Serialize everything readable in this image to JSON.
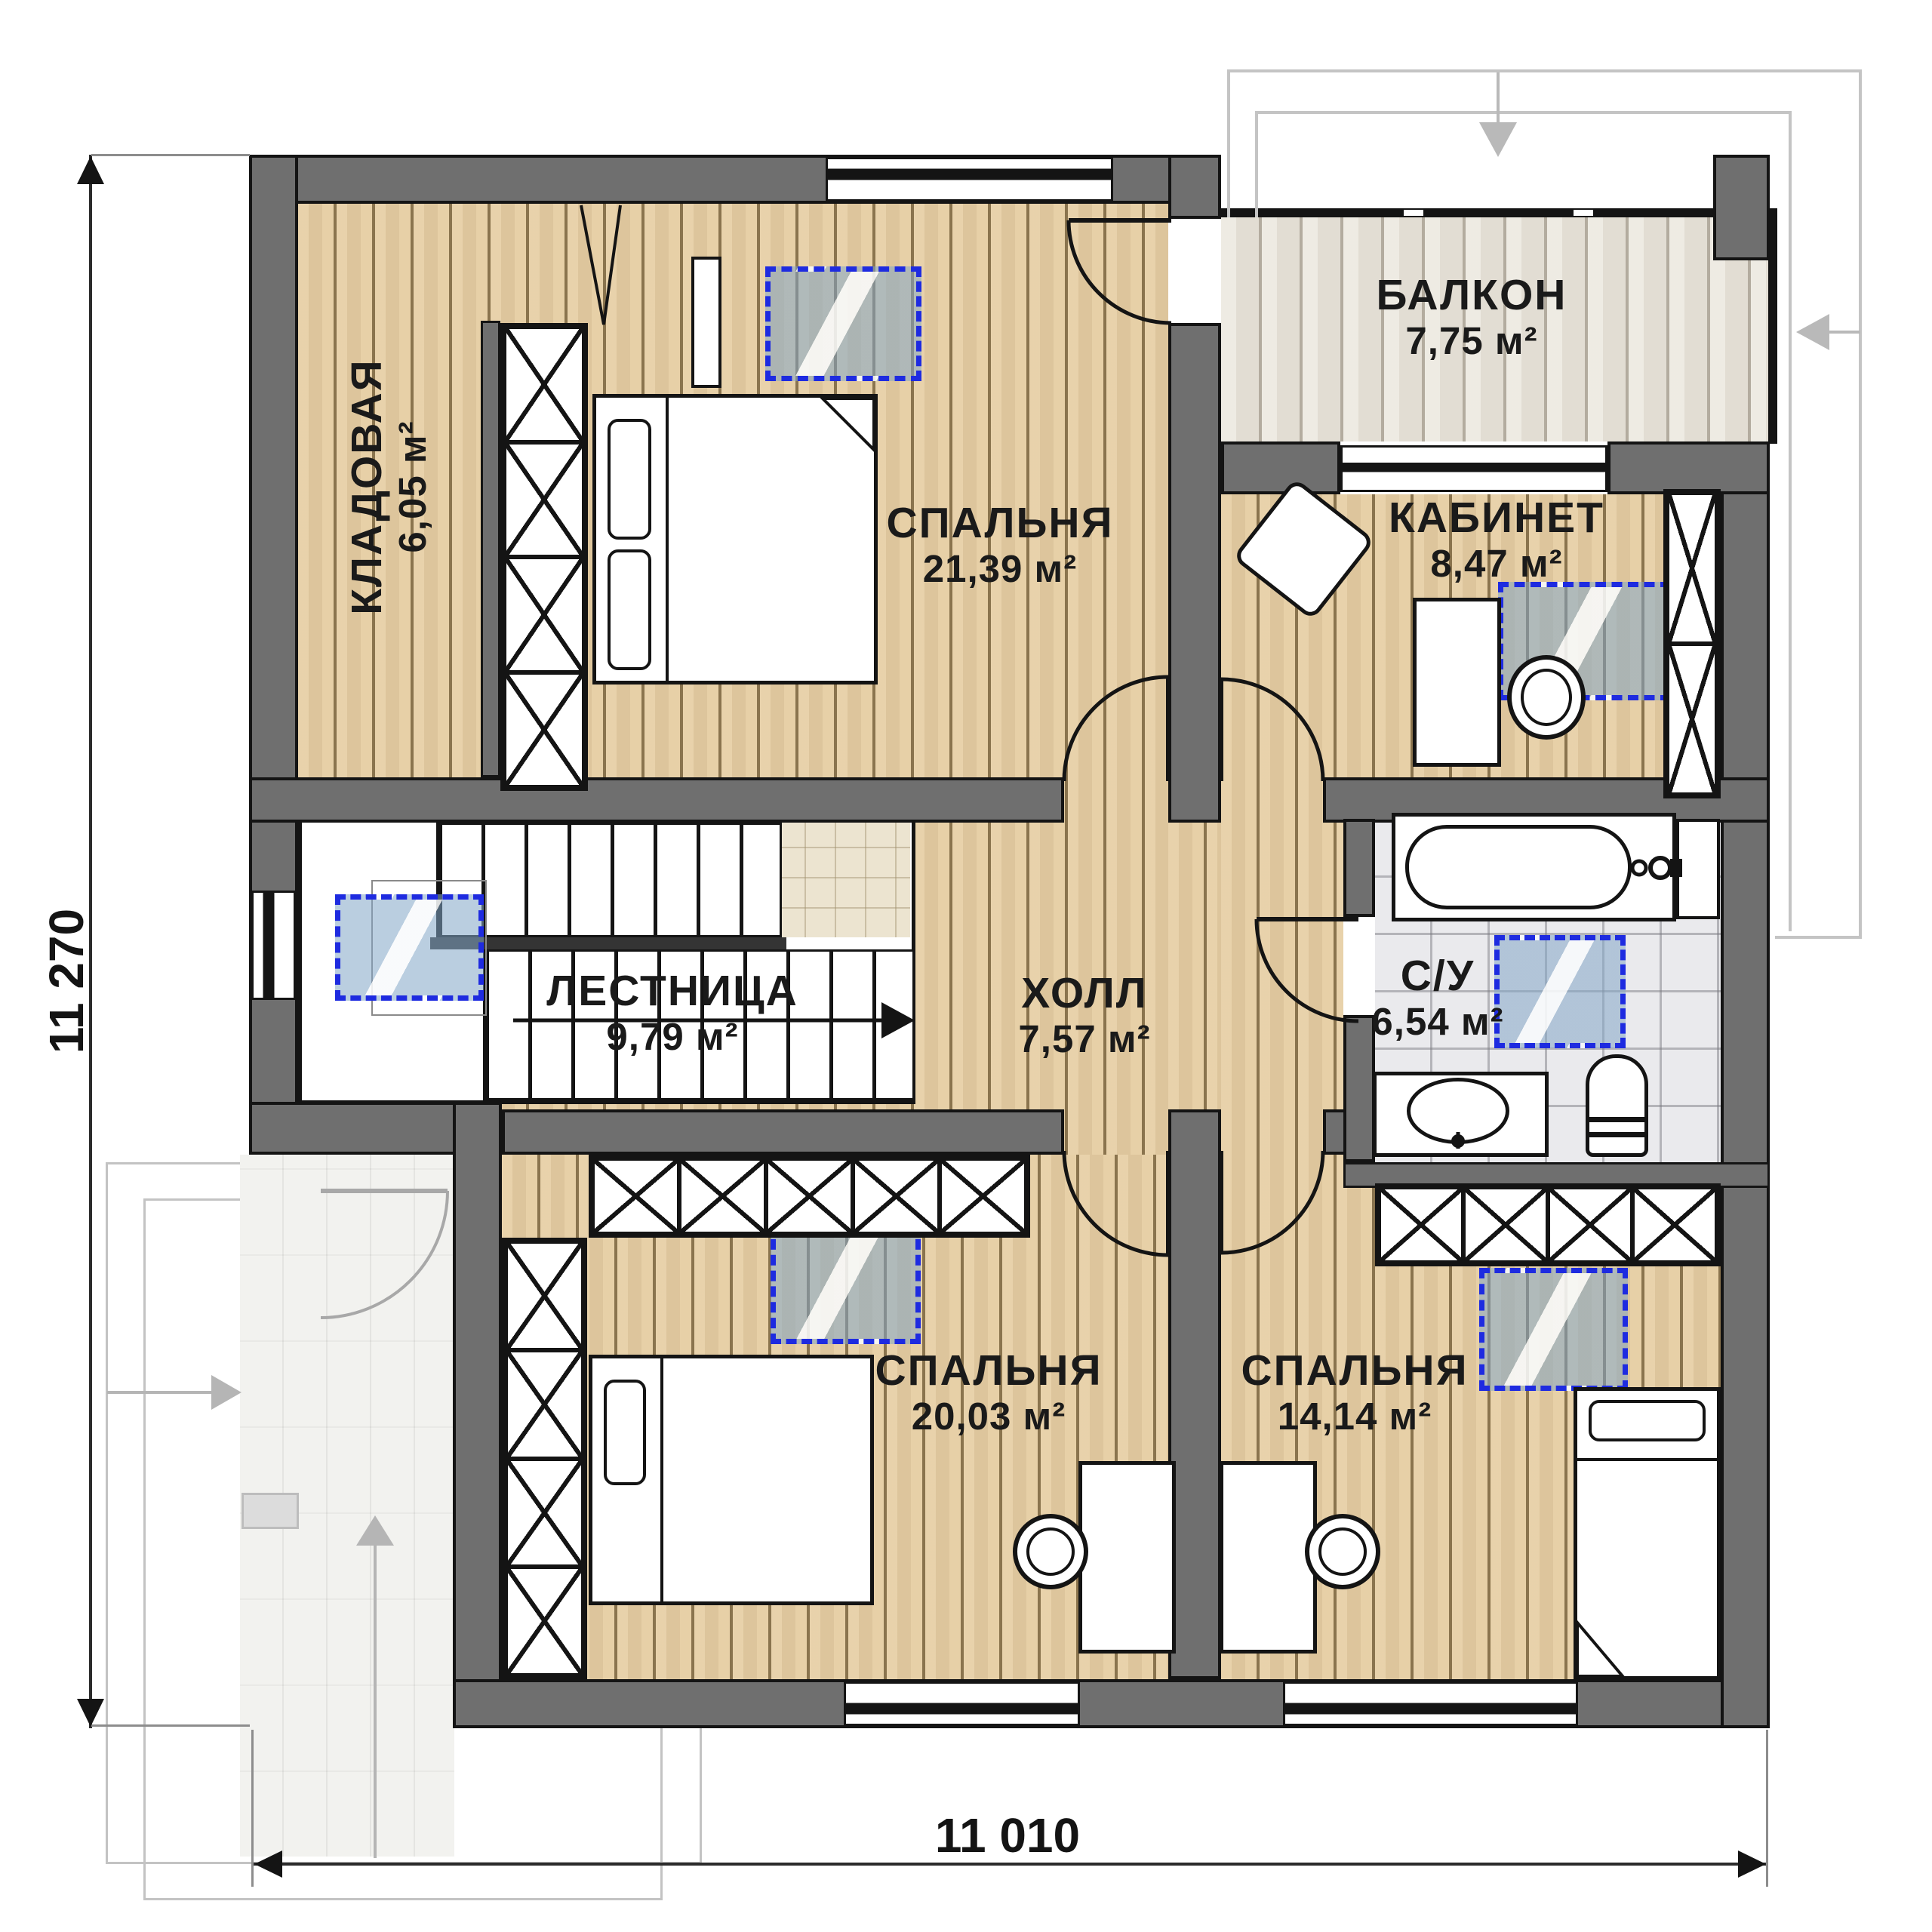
{
  "plan_title": "second-floor-plan",
  "rooms": [
    {
      "key": "balcony",
      "name": "БАЛКОН",
      "area": "7,75 м²"
    },
    {
      "key": "storage",
      "name": "КЛАДОВАЯ",
      "area": "6,05 м²"
    },
    {
      "key": "bedroom_master",
      "name": "СПАЛЬНЯ",
      "area": "21,39 м²"
    },
    {
      "key": "office",
      "name": "КАБИНЕТ",
      "area": "8,47 м²"
    },
    {
      "key": "stairs",
      "name": "ЛЕСТНИЦА",
      "area": "9,79 м²"
    },
    {
      "key": "hall",
      "name": "ХОЛЛ",
      "area": "7,57 м²"
    },
    {
      "key": "bathroom",
      "name": "С/У",
      "area": "6,54 м²"
    },
    {
      "key": "bedroom_2",
      "name": "СПАЛЬНЯ",
      "area": "20,03 м²"
    },
    {
      "key": "bedroom_3",
      "name": "СПАЛЬНЯ",
      "area": "14,14 м²"
    }
  ],
  "dimensions": {
    "vertical": "11 270",
    "horizontal": "11 010"
  },
  "colors": {
    "wall": "#6f6f6f",
    "wall_outline": "#141414",
    "wood_floor": "#e6cda2",
    "balcony_wood": "#e9e4da",
    "bathroom_tile": "#eaeaed",
    "skylight_dash": "#1e2be0",
    "skylight_glass": "#82a5c6",
    "ghost_outline": "#c3c3c3"
  }
}
